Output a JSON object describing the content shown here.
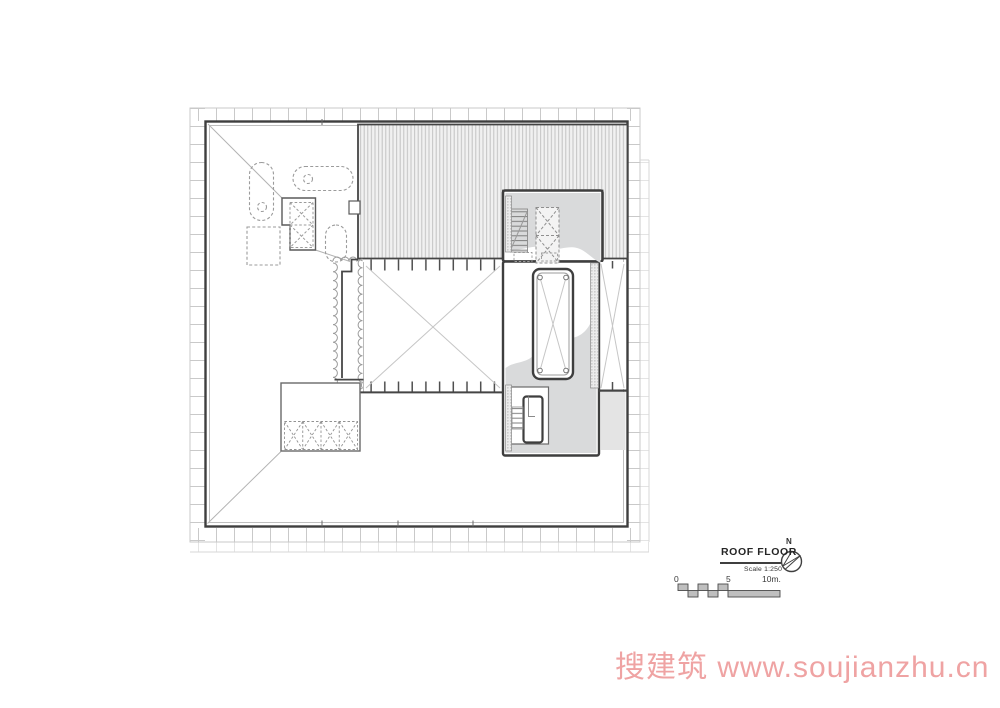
{
  "title_block": {
    "title": "ROOF FLOOR",
    "scale": "Scale 1:250"
  },
  "north": {
    "label": "N"
  },
  "scale_bar": {
    "labels": [
      "0",
      "5",
      "10m."
    ]
  },
  "watermark": {
    "text": "搜建筑 www.soujianzhu.cn",
    "color": "#efa3a3"
  },
  "colors": {
    "line_dark": "#3f3f3f",
    "line_light": "#b3b3b3",
    "roof_stripe": "#c3c3c3",
    "core_gray": "#d9dadb",
    "parapet_gray": "#e4e4e4"
  }
}
